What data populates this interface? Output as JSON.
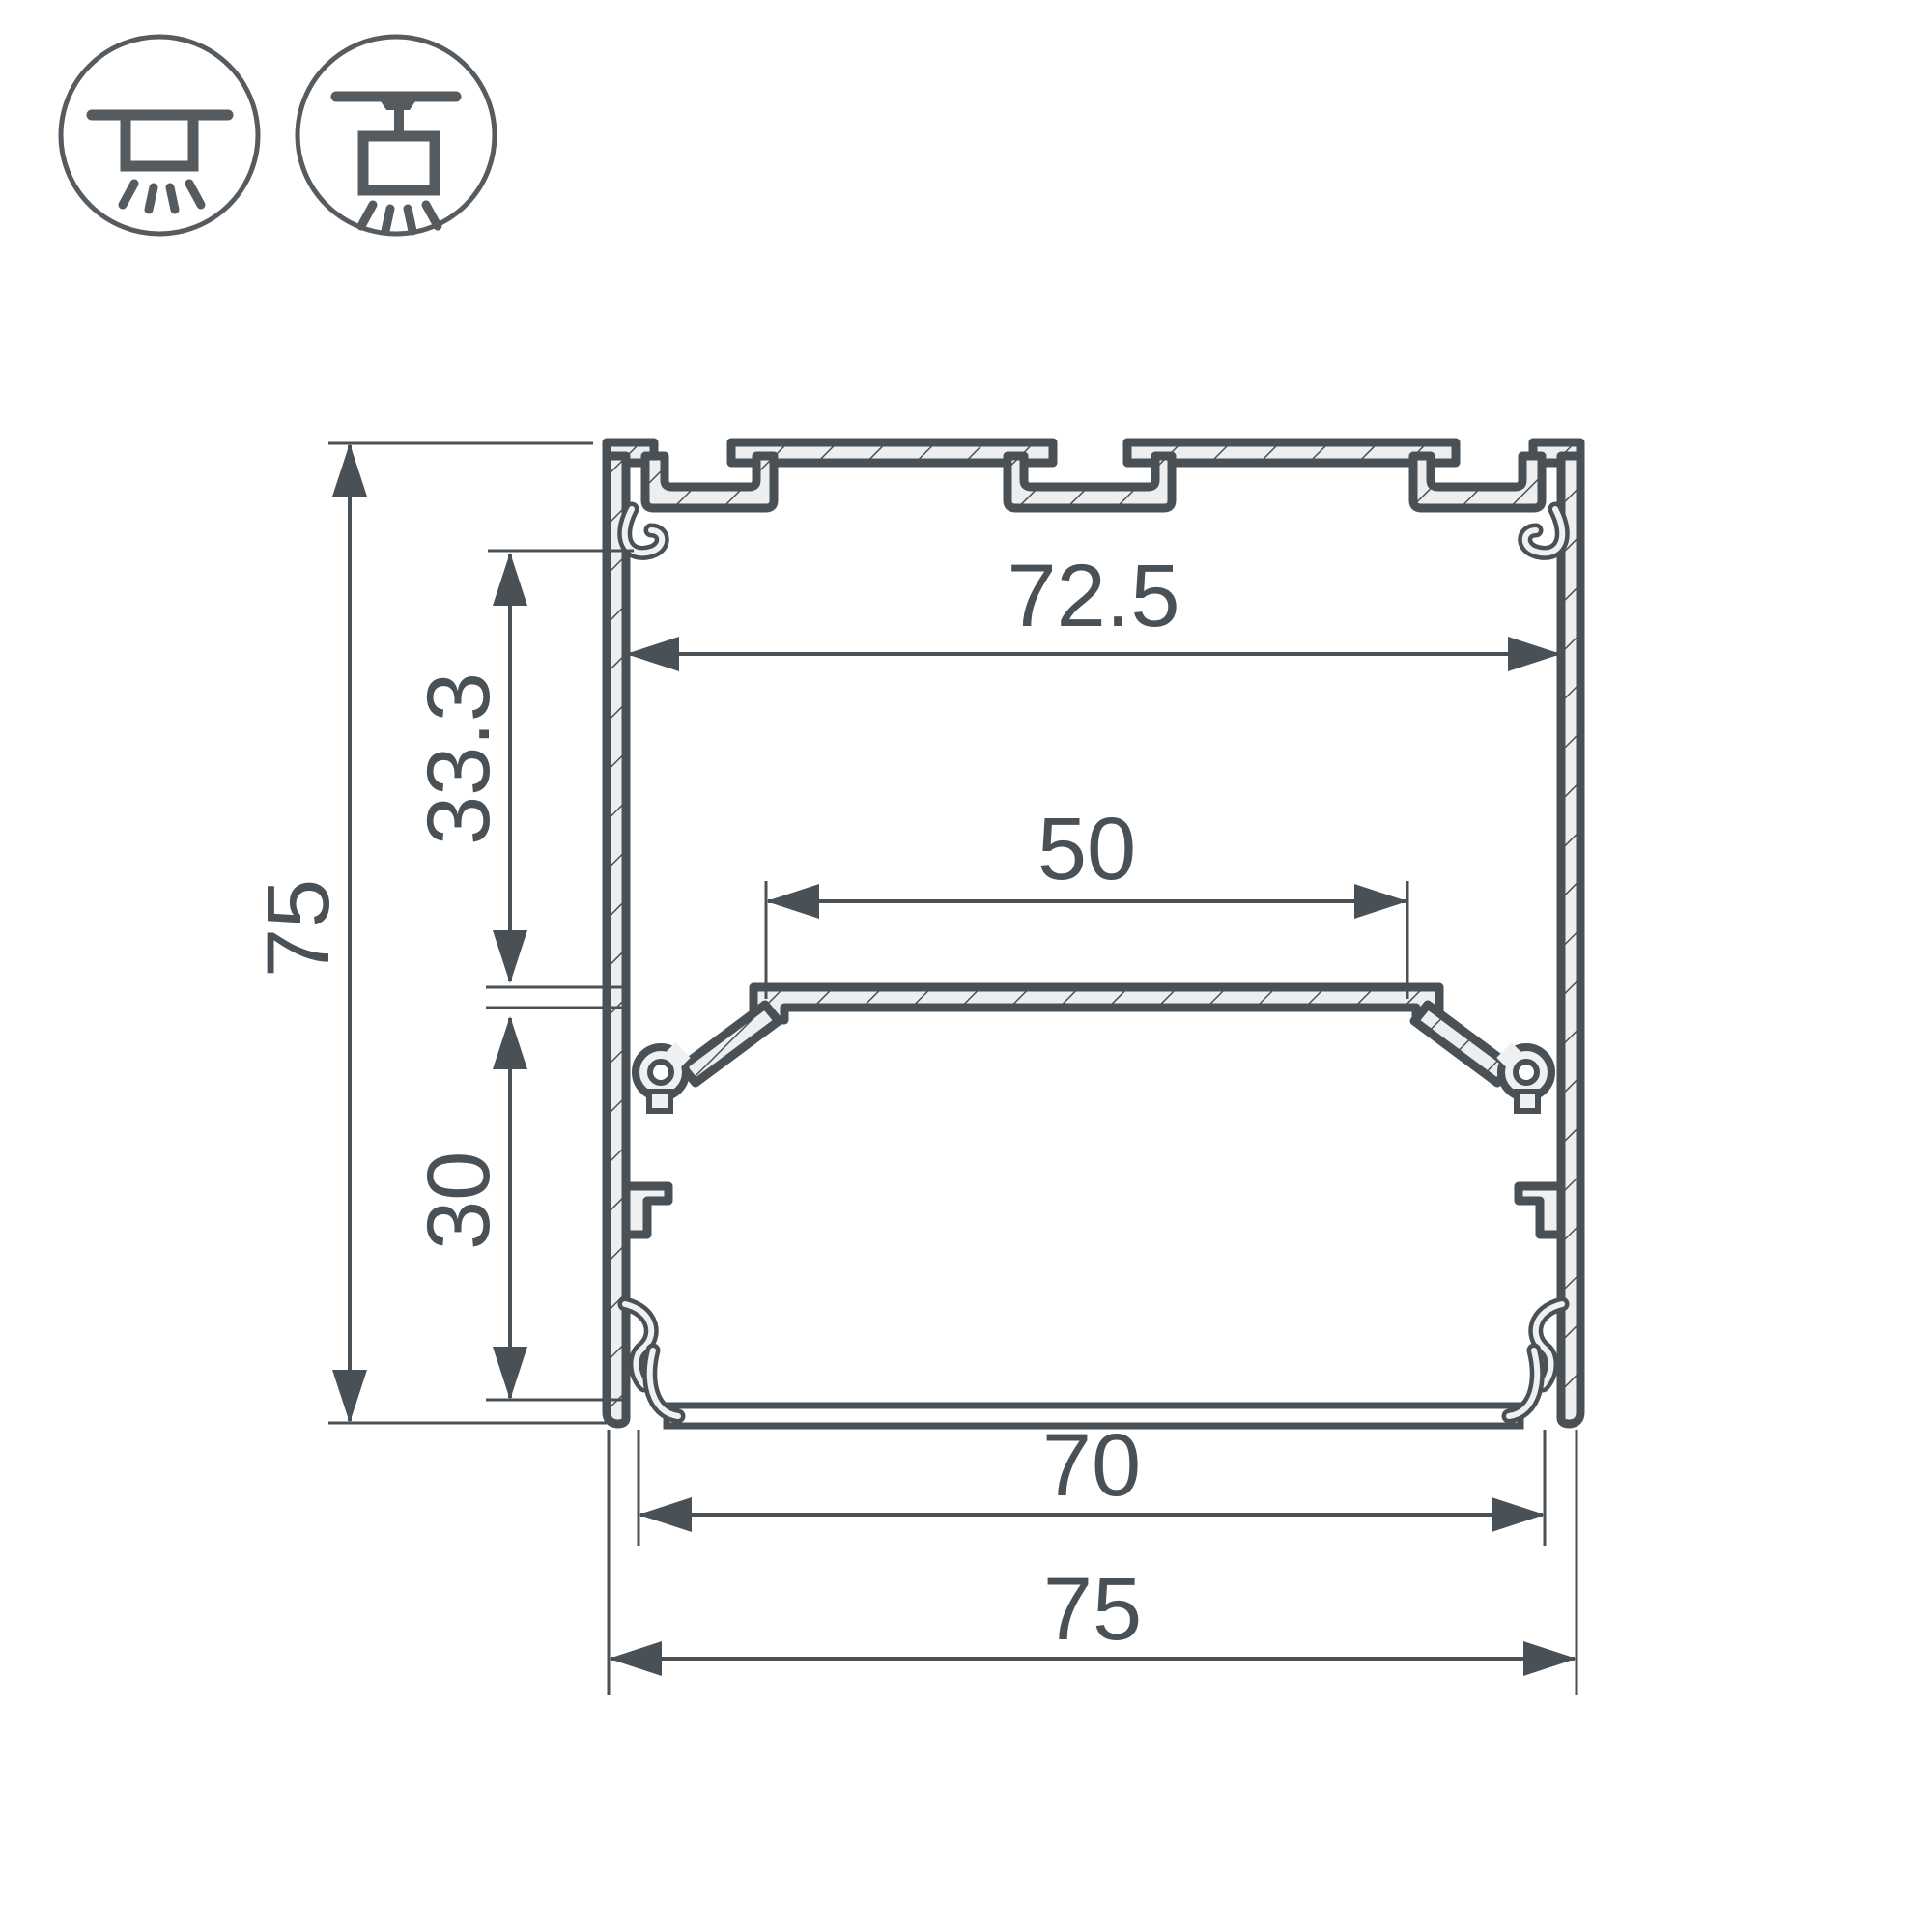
{
  "drawing": {
    "dimensions": {
      "overall_height": "75",
      "upper_inner_height": "33.3",
      "lower_inner_height": "30",
      "inner_width_top": "72.5",
      "led_shelf_width": "50",
      "inner_width_bottom": "70",
      "overall_width": "75"
    },
    "icons": [
      {
        "name": "surface-mount-icon",
        "meaning": "surface ceiling mounting"
      },
      {
        "name": "suspended-mount-icon",
        "meaning": "suspended pendant mounting"
      }
    ],
    "colors": {
      "line": "#4a5156",
      "aluminum_fill": "#eceef0",
      "background": "#ffffff"
    }
  }
}
